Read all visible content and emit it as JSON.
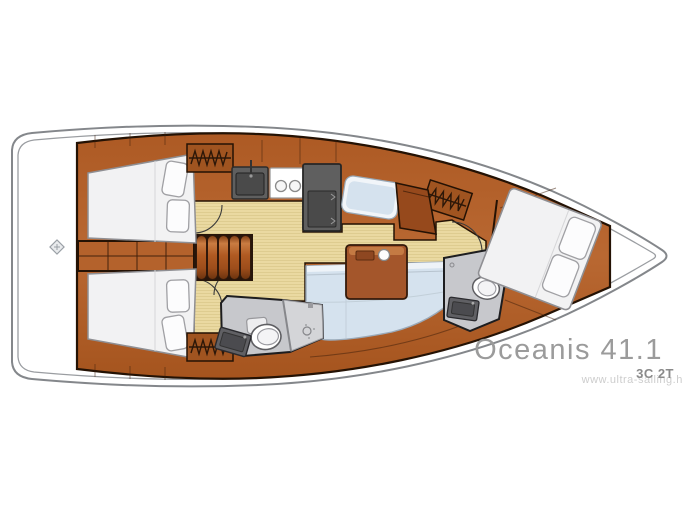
{
  "diagram": {
    "title": "Oceanis 41.1",
    "layout_code": "3C 2T",
    "watermark": "www.ultra-sailing.hr"
  },
  "colors": {
    "hull_outline": "#84878b",
    "hull_inner_line": "#9a9da1",
    "interior_outline": "#241204",
    "wood": "#b4622c",
    "wood_dark": "#8a4a1f",
    "wood_panel": "#a05420",
    "floor": "#ead9a1",
    "floor_stripe": "#dcc98c",
    "mattress": "#f2f2f3",
    "pillow": "#fcfcfd",
    "upholstery": "#d5e2ee",
    "upholstery_piping": "#eef3f8",
    "head_floor": "#c7c8cc",
    "shower_floor": "#d4d5d8",
    "appliance": "#5f5f5f",
    "appliance_inner": "#4a4a4a",
    "stove": "#ffffff",
    "table_wood": "#a4562b",
    "title_text": "#9b9b9b",
    "code_text": "#8a8a8a",
    "watermark_text": "#cdcdcd"
  }
}
